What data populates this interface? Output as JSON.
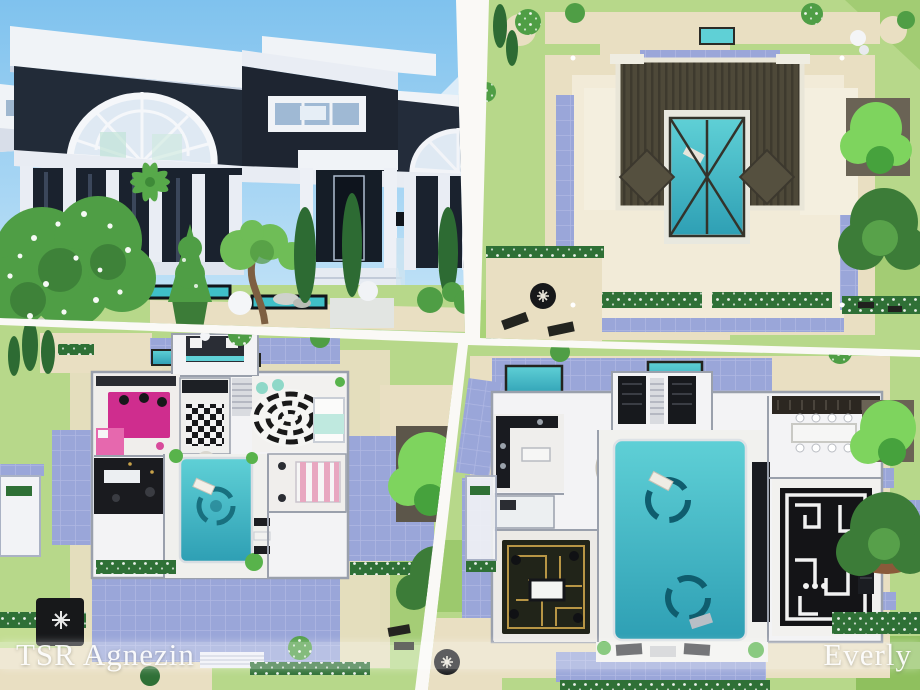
{
  "watermark": {
    "left": "TSR Agnezin",
    "right": "Everly"
  },
  "palette": {
    "sky": "#7fc2ee",
    "sky_low": "#c9e6f8",
    "lawn": "#b7d88a",
    "lawn_dark": "#9cc96d",
    "sand": "#e9dfc2",
    "sand_light": "#f2ebd8",
    "periwinkle": "#9aa6d9",
    "periwinkle_light": "#b4bce6",
    "pool": "#5fd0d6",
    "pool_deep": "#2e9fb4",
    "roof_dark": "#4e4939",
    "wall_dark": "#222b38",
    "trim_white": "#f0f3f7",
    "hedge": "#2f7036",
    "bush": "#4f9e45",
    "bush_light": "#7ed45e",
    "magenta_rug": "#cf2d8e",
    "rug_black": "#17181a",
    "gold": "#c8a24a"
  }
}
